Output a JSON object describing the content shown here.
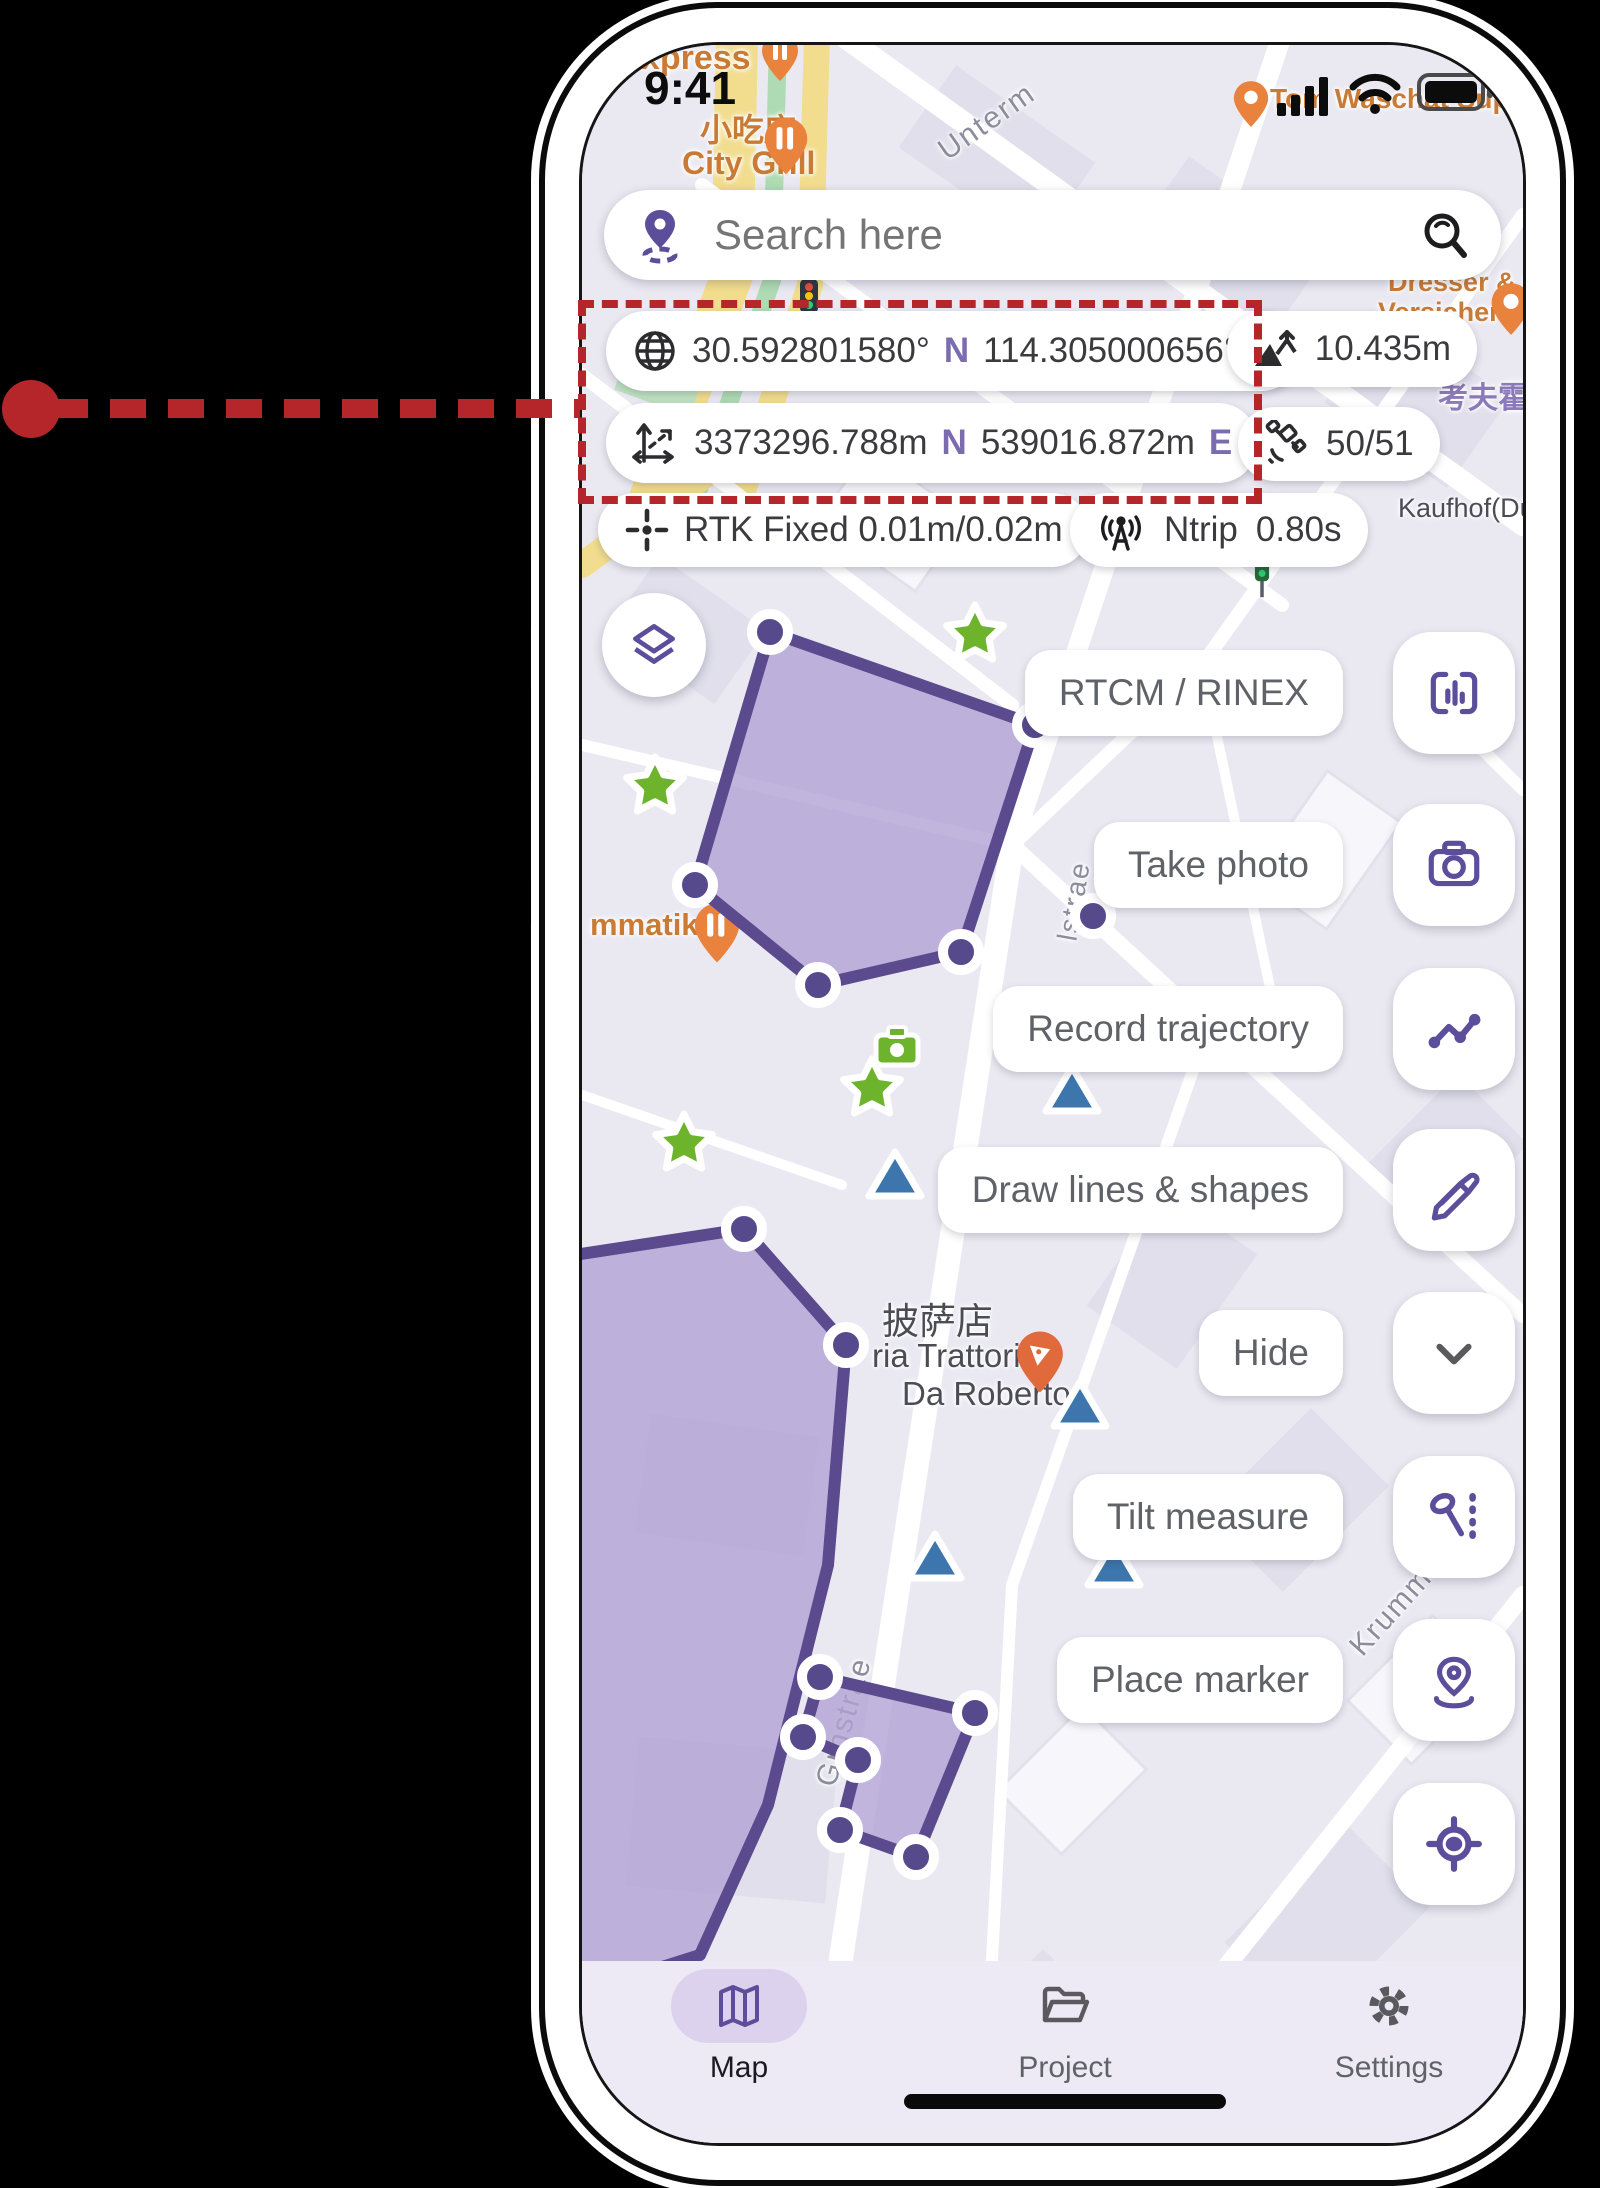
{
  "annotation": {
    "purpose": "callout highlighting the coordinates panel",
    "color": "#b5262a"
  },
  "phone": {
    "status_bar": {
      "time": "9:41"
    },
    "map_search": {
      "placeholder": "Search here"
    },
    "telemetry": {
      "lat": "30.592801580°",
      "lat_hem": "N",
      "lon": "114.305000656°",
      "lon_hem": "E",
      "northing": "3373296.788m",
      "northing_hem": "N",
      "easting": "539016.872m",
      "easting_hem": "E",
      "altitude": "10.435m",
      "satellites": "50/51",
      "rtk": "RTK Fixed 0.01m/0.02m",
      "ntrip": "Ntrip",
      "ntrip_delay": "0.80s"
    },
    "tool_labels": {
      "rtcm": "RTCM / RINEX",
      "photo": "Take photo",
      "trajectory": "Record trajectory",
      "draw": "Draw lines & shapes",
      "hide": "Hide",
      "tilt": "Tilt measure",
      "marker": "Place marker"
    },
    "nav": {
      "map": "Map",
      "project": "Project",
      "settings": "Settings"
    },
    "map_labels": {
      "express": "express",
      "snack_shop": "小吃店",
      "city_grill": "City Grill",
      "unterm": "Unterm",
      "tom": "Tom Waschat Supper",
      "dresser": "Dresser & Co.",
      "versicherung": "Versicherungsgesch",
      "kaufhof_cn": "考夫霍夫(",
      "kaufhof_de": "Kaufhof(Düs",
      "matikoff": "mmatikoff",
      "pizza_cn": "披萨店",
      "trattoria_1": "ria Trattoria",
      "trattoria_2": "Da Roberto",
      "grnstrasse": "Grnstrae",
      "lstrasse": "lstrae",
      "krumm": "Krumm",
      "ae": "ae",
      "rk": "r k"
    },
    "colors": {
      "accent_purple": "#5d4e9c",
      "polygon_fill": "#b1a3d4",
      "polygon_stroke": "#5b4a8e",
      "star_green": "#6db32c",
      "triangle_blue": "#3c76ad",
      "poi_orange": "#e8823d",
      "annotation_red": "#b5262a"
    }
  }
}
